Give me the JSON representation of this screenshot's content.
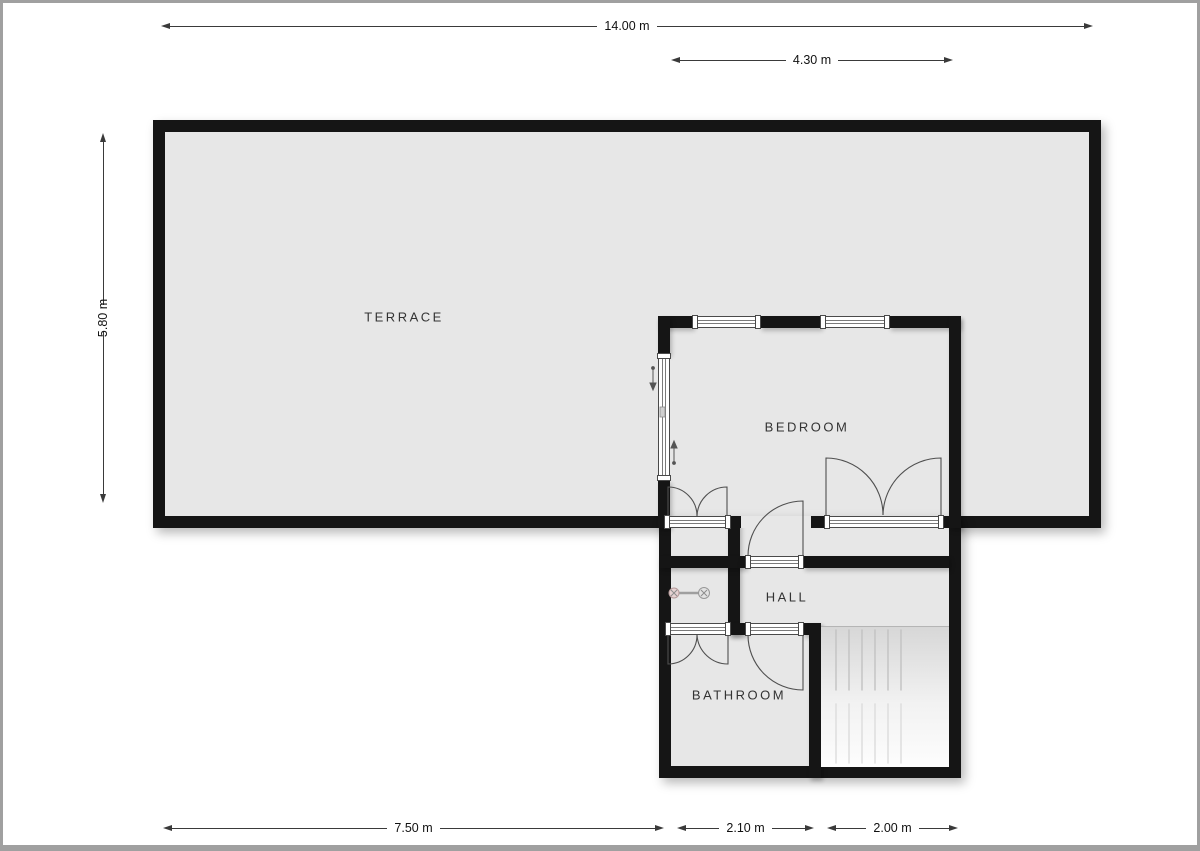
{
  "rooms": [
    {
      "name": "terrace",
      "label": "TERRACE"
    },
    {
      "name": "bedroom",
      "label": "BEDROOM"
    },
    {
      "name": "hall",
      "label": "HALL"
    },
    {
      "name": "bathroom",
      "label": "BATHROOM"
    }
  ],
  "dimensions": {
    "top_total": "14.00 m",
    "top_partial": "4.30 m",
    "left_height": "5.80 m",
    "bottom_left": "7.50 m",
    "bottom_middle": "2.10 m",
    "bottom_right": "2.00 m"
  },
  "colors": {
    "wall": "#151515",
    "floor": "#e7e7e7",
    "dim_line": "#3a3a3a",
    "canvas": "#ffffff",
    "frame": "#a0a0a0",
    "door_line": "#4f4f4f"
  },
  "icons": {
    "radiator": "radiator-icon",
    "sliding_door_direction": "arrow-up-down-icon",
    "stairs": "stairs-icon"
  }
}
